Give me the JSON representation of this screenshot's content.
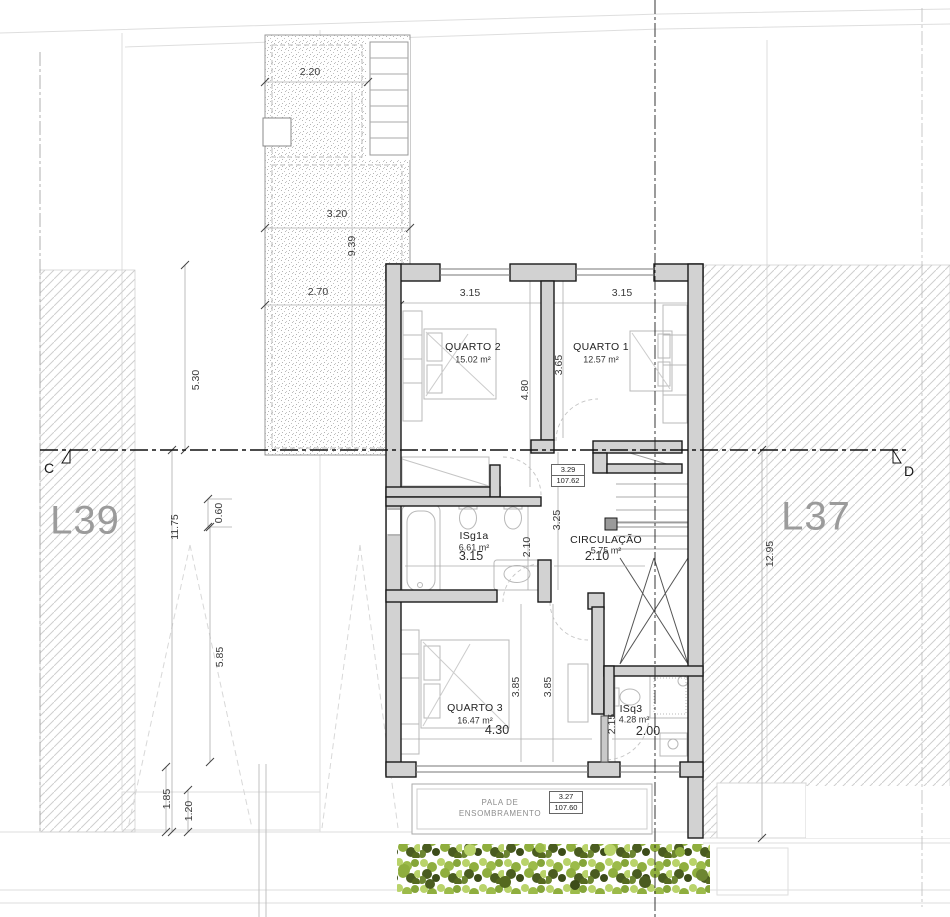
{
  "plan": {
    "lots": {
      "left": "L39",
      "right": "L37"
    },
    "section_markers": {
      "left": "C",
      "right": "D"
    },
    "rooms": [
      {
        "name": "QUARTO 2",
        "area": "15.02 m²"
      },
      {
        "name": "QUARTO 1",
        "area": "12.57 m²"
      },
      {
        "name": "ISg1a",
        "area": "6.61 m²"
      },
      {
        "name": "CIRCULAÇÃO",
        "area": "5.75 m²"
      },
      {
        "name": "QUARTO 3",
        "area": "16.47 m²"
      },
      {
        "name": "ISq3",
        "area": "4.28 m²"
      }
    ],
    "levels": [
      {
        "height": "3.29",
        "elevation": "107.62"
      },
      {
        "height": "3.27",
        "elevation": "107.60"
      }
    ],
    "shade_canopy": {
      "line1": "PALA DE",
      "line2": "ENSOMBRAMENTO"
    },
    "dims": {
      "terrace_width": "2.20",
      "terrace_width2": "3.20",
      "terrace_length": "9.39",
      "terrace_width3": "2.70",
      "left_1": "5.30",
      "left_2": "11.75",
      "left_3": "0.60",
      "left_4": "5.85",
      "left_5": "1.85",
      "left_6": "1.20",
      "right_1": "12.95",
      "q2_w": "3.15",
      "q1_w": "3.15",
      "q2_h": "4.80",
      "q1_h": "3.65",
      "corr_h": "3.25",
      "bath_h": "2.10",
      "bath_w": "3.15",
      "circ_w": "2.10",
      "q3_h1": "3.85",
      "q3_h2": "3.85",
      "q3_w": "4.30",
      "isq3_h": "2.15",
      "isq3_w": "2.00"
    },
    "colors": {
      "wall_fill": "#d2d2d2",
      "wall_edge": "#1a1a1a",
      "hedge_light": "#b9d36a",
      "hedge_mid": "#8fae3e",
      "hedge_dark": "#4a5c20",
      "lot_label": "#9b9b9b"
    }
  }
}
